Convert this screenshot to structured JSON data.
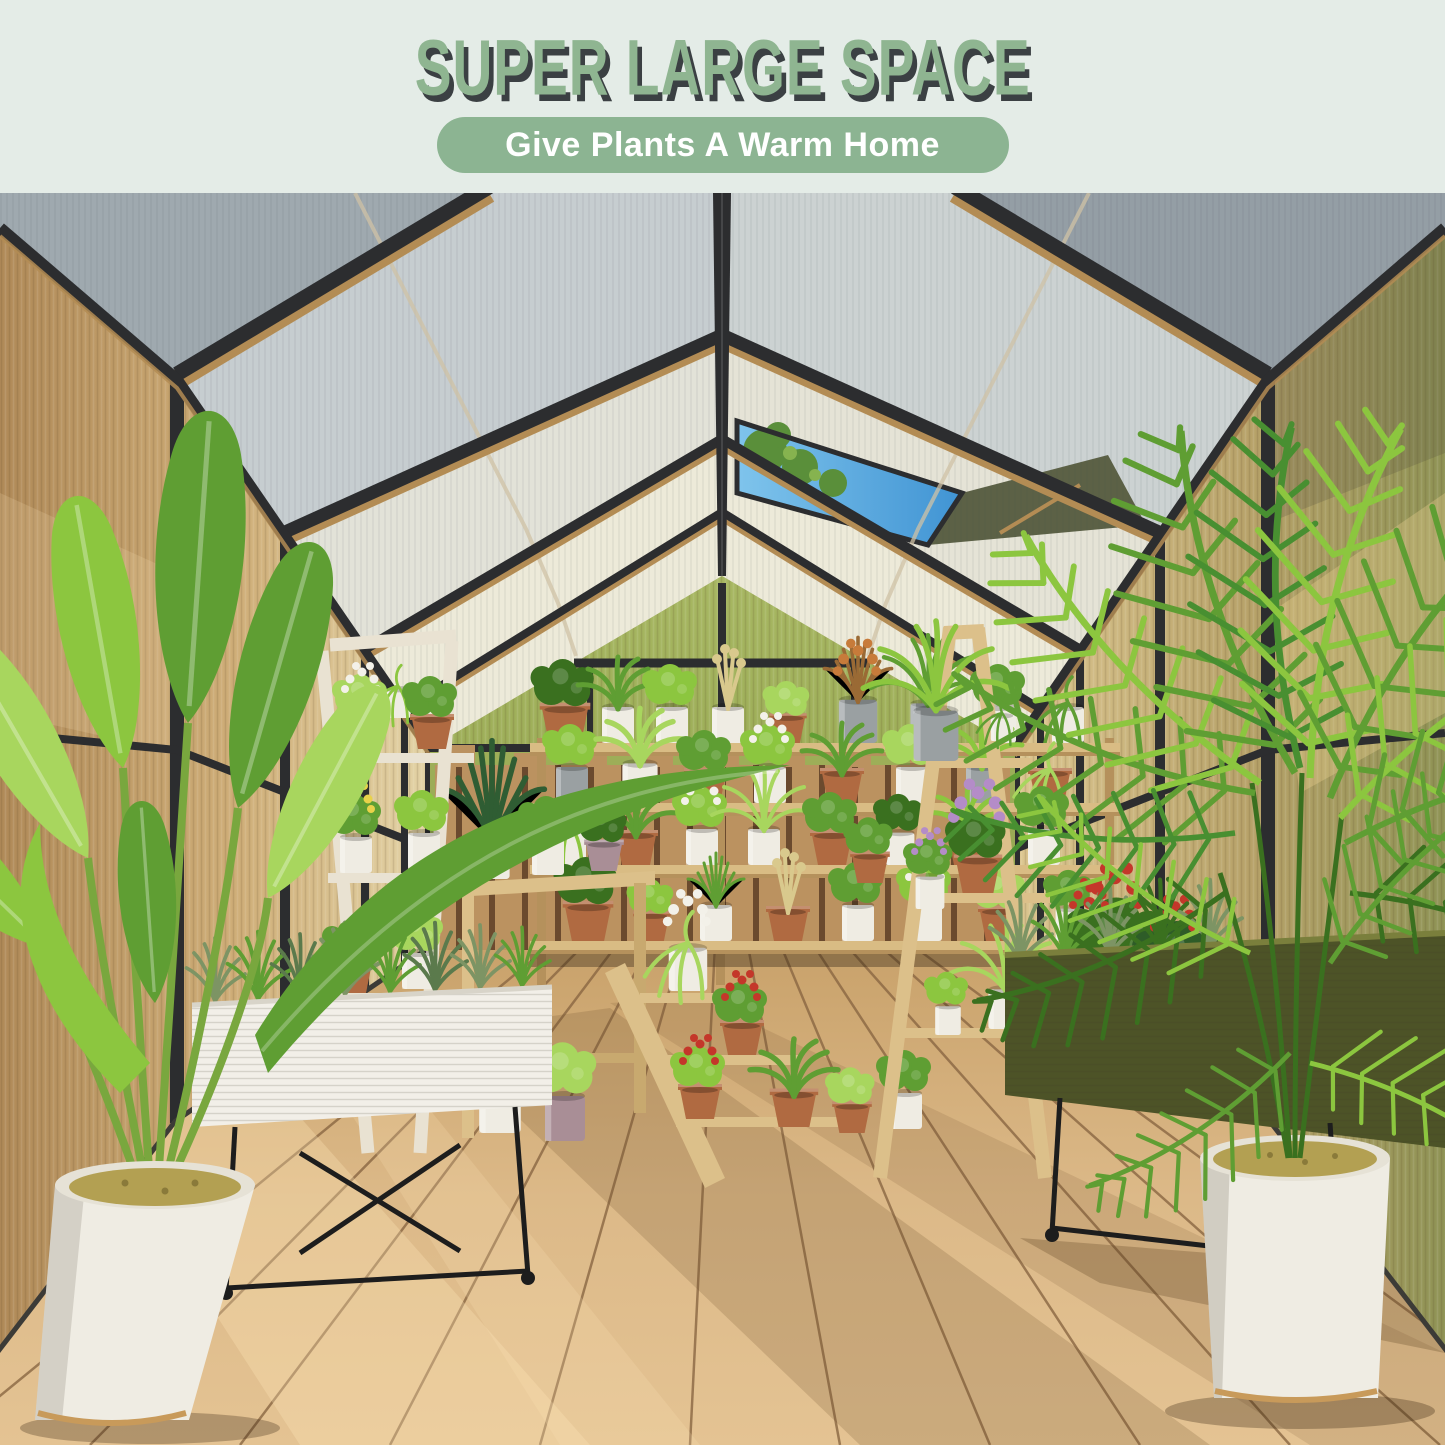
{
  "header": {
    "title": "SUPER LARGE SPACE",
    "tagline": "Give Plants A Warm Home"
  },
  "colors": {
    "bg_mint": "#e4ece7",
    "title_green": "#8fb591",
    "title_shadow": "#3b4043",
    "pill_green": "#8cb492",
    "pill_text": "#ffffff",
    "frame_dark": "#2c2d2f",
    "frame_bronze": "#b38c54",
    "roof_near": "#9fa9af",
    "roof_mid": "#c6cdd0",
    "roof_far": "#e2e2d8",
    "roof_cream": "#edead9",
    "sky_blue": "#3f93d3",
    "sky_blue_light": "#7fc4ec",
    "vent_flap": "#5c6146",
    "wall_amber_dark": "#b08a58",
    "wall_amber": "#cfae78",
    "wall_amber_light": "#e3d3a6",
    "wall_olive": "#8f9355",
    "gable_green": "#93a44e",
    "gable_green_light": "#a7b762",
    "fence_wood": "#bb9260",
    "fence_gap": "#6b4a2e",
    "shelf_wood": "#d9bc84",
    "shelf_wood_dark": "#b5915c",
    "ladder_white": "#e9e2d2",
    "ladder_wood": "#dcc08a",
    "floor_light": "#dcb988",
    "floor_mid": "#c9a26b",
    "plank_line": "#8a6743",
    "shadow_brown": "#6a4a2a",
    "sun_glow": "#ffe7b8",
    "planter_white": "#f2efe8",
    "planter_olive": "#4d5327",
    "planter_olive_lip": "#7a7f3c",
    "metal_black": "#1d1d1d",
    "pot_white": "#efece3",
    "pot_terracotta": "#b06a41",
    "pot_gray": "#9aa0a2",
    "pot_mauve": "#a98e96",
    "soil_moss": "#b3a052",
    "gold": "#c89a5a",
    "leaf_bright": "#8cc63f",
    "leaf_mid": "#5f9e33",
    "leaf_dark": "#3a701f",
    "leaf_pale": "#a8d65e",
    "herb_green": "#7d9464",
    "plume_tan": "#d9c98d",
    "flower_purple": "#b48cc8",
    "flower_red": "#c4372a",
    "flower_white": "#f3f1e9",
    "flower_yellow": "#e8d24a",
    "flower_orange": "#c77b3a"
  }
}
